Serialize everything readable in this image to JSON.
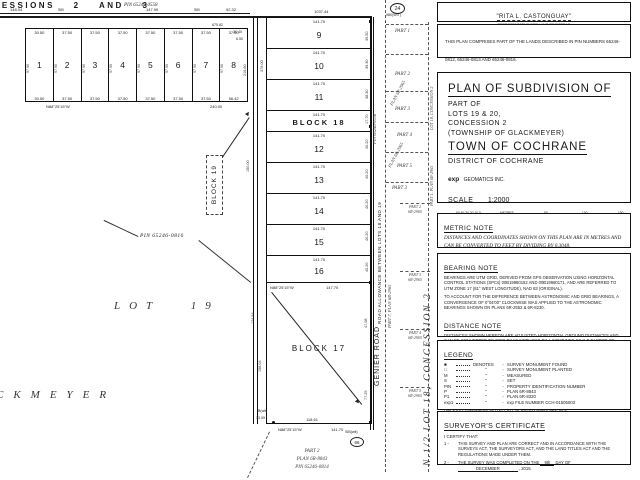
{
  "map": {
    "concessions_label": "SESSIONS 2 AND 3",
    "pin_0558": "PIN 65246-0558",
    "d148": "148.04",
    "d147": "147.99",
    "d92": "92.32",
    "d1037": "1037.44",
    "sib": "SIB",
    "row_lots": [
      "1",
      "2",
      "3",
      "4",
      "5",
      "6",
      "7",
      "8"
    ],
    "row_top_dims": [
      "30.50",
      "37.50",
      "37.50",
      "37.50",
      "37.50",
      "37.50",
      "37.50",
      "37.50"
    ],
    "row_bottom_dims": [
      "30.50",
      "37.50",
      "37.50",
      "37.50",
      "37.50",
      "37.50",
      "37.50",
      "56.42"
    ],
    "row_depth": "97.90",
    "d675": "675.82",
    "d3040": "30.40",
    "d650": "6.50",
    "d21660": "216.60",
    "d240": "240.00",
    "bearing_n88": "N88°25'15\"W",
    "mid_dim": "141.70",
    "mid_lots": [
      "9",
      "10",
      "11",
      "12",
      "13",
      "14",
      "15",
      "16"
    ],
    "block18": "BLOCK 18",
    "block19": "BLOCK 19",
    "block17": "BLOCK 17",
    "d14770": "147.70",
    "right_ticks": [
      "39.50",
      "39.30",
      "38.30",
      "17.70",
      "40.20",
      "40.20",
      "40.20",
      "40.20",
      "40.20"
    ],
    "d150": "150.00",
    "d376": "376.00",
    "pin_0816": "PIN 65246-0816",
    "lot19": "LOT 19",
    "glackmeyer": "CKMEYER",
    "pin_0556": "PIN 65246-0556",
    "road_allowance": "ROAD ALLOWANCE BETWEEN LOTS 18 AND 19",
    "genier_road": "GENIER ROAD",
    "part7": "PART 7, PLAN 6R-2965",
    "m24": "24",
    "m24_sub": "980(WIT)",
    "m66": "66",
    "strip_parts": [
      "PART 1",
      "PART 2",
      "PART 3",
      "PART 4",
      "PART 5",
      "PART 3"
    ],
    "plan_6r2965": "PLAN 6R-2965",
    "lot18_side": "LOT 18, CONCESSION 2",
    "part1_side": "PART 1, PLAN 6R-2965",
    "nhalf_side": "N.1/2 LOT 18, CONCESSION 2",
    "side_parts": [
      {
        "p": "PART 2",
        "plan": "6R-2965"
      },
      {
        "p": "PART 3",
        "plan": "6R-2965"
      },
      {
        "p": "PART 4",
        "plan": "6R-2965"
      },
      {
        "p": "PART 5",
        "plan": "6R-2965"
      }
    ],
    "blk17": {
      "d47": "47.08",
      "d77": "77.25",
      "d174": "174.54",
      "d158": "158.04",
      "d118": "118.61",
      "d141": "141.70",
      "d1309": "13.09",
      "ib_wit": "IB(wit)",
      "sib_wit": "SIB(wit)"
    },
    "part2_block": {
      "l1": "PART 2",
      "l2": "PLAN 6R-8843",
      "l3": "PIN 65246-0814"
    }
  },
  "registrar": {
    "name": "\"RITA L. CASTONGUAY\"",
    "role1": "REPRESENTATIVE FOR LAND REGISTRAR",
    "role2": "FOR THE LAND TITLES DIVISION OF COCHRANE"
  },
  "comprises": {
    "text": "THIS PLAN COMPRISES PART OF THE LANDS DESCRIBED IN PIN NUMBERS 65246-0812, 65246-0813 AND 65246-0816."
  },
  "title_block": {
    "l1": "PLAN OF SUBDIVISION OF",
    "l2": "PART OF",
    "l3": "LOTS 19 & 20,",
    "l4": "CONCESSION 2",
    "l5": "(TOWNSHIP OF GLACKMEYER)",
    "l6": "TOWN OF COCHRANE",
    "l7": "DISTRICT OF COCHRANE",
    "firm_bold": "exp",
    "firm_rest": "GEOMATICS INC.",
    "scale": "SCALE",
    "ratio": "1:2000",
    "bar_left": "50 40 30 20 10 0",
    "bar_unit": "METRES",
    "bar_50": "50",
    "bar_100": "100",
    "bar_150": "150"
  },
  "metric_note": {
    "title": "METRIC NOTE",
    "body": "DISTANCES AND COORDINATES SHOWN ON THIS PLAN ARE IN METRES AND CAN BE CONVERTED TO FEET BY DIVIDING BY 0.3048."
  },
  "bearing_note": {
    "title": "BEARING NOTE",
    "p1": "BEARINGS ARE UTM GRID, DERIVED FROM GPS OBSERVATION USING HORIZONTAL CONTROL STATIONS (SPCs) 00B19980152 AND 00B19980171, AND ARE REFERRED TO UTM ZONE 17 (81° WEST LONGITUDE), NAD 83 (ORIGINAL).",
    "p2": "TO ACCOUNT FOR THE DIFFERENCE BETWEEN ASTRONOMIC AND GRID BEARINGS, A CONVERGENCE OF 0°04'00\" CLOCKWISE WAS APPLIED TO THE ASTRONOMIC BEARINGS SHOWN ON PLANS 6R-2552 & 6R-8230."
  },
  "distance_note": {
    "title": "DISTANCE NOTE",
    "body": "DISTANCES SHOWN HEREON ARE ADJUSTED HORIZONTAL GROUND DISTANCES AND CAN BE CONVERTED TO GRID BY MULTIPLYING BY A COMBINED SCALE FACTOR OF 0.999840."
  },
  "legend": {
    "title": "LEGEND",
    "denotes": "DENOTES",
    "ditto": "\"",
    "sep": "-",
    "rows": [
      {
        "sym": "■",
        "def": "SURVEY MONUMENT FOUND"
      },
      {
        "sym": "□",
        "def": "SURVEY MONUMENT PLANTED"
      },
      {
        "sym": "M",
        "def": "MEASURED"
      },
      {
        "sym": "S",
        "def": "SET"
      },
      {
        "sym": "PIN",
        "def": "PROPERTY IDENTIFICATION NUMBER"
      },
      {
        "sym": "P",
        "def": "PLAN 6R-8843"
      },
      {
        "sym": "P1",
        "def": "PLAN 6R-8320"
      },
      {
        "sym": "exp1",
        "def": "exp FILE NUMBER CCH-01505003"
      }
    ],
    "footer": "UNLESS OTHERWISE NOTED, ALL PLANTED BARS ARE IB'S."
  },
  "certificate": {
    "title": "SURVEYOR'S CERTIFICATE",
    "intro": "I CERTIFY THAT:",
    "n1": "1  -",
    "item1": "THIS SURVEY AND PLAN ARE CORRECT AND IN ACCORDANCE WITH THE SURVEYS ACT, THE SURVEYORS ACT, AND THE LAND TITLES ACT AND THE REGULATIONS MADE UNDER THEM.",
    "n2": "2  -",
    "item2_pre": "THE SURVEY WAS COMPLETED ON THE",
    "day": "9th",
    "item2_mid": "DAY OF",
    "month": "DECEMBER",
    "item2_post": ", 2015."
  }
}
